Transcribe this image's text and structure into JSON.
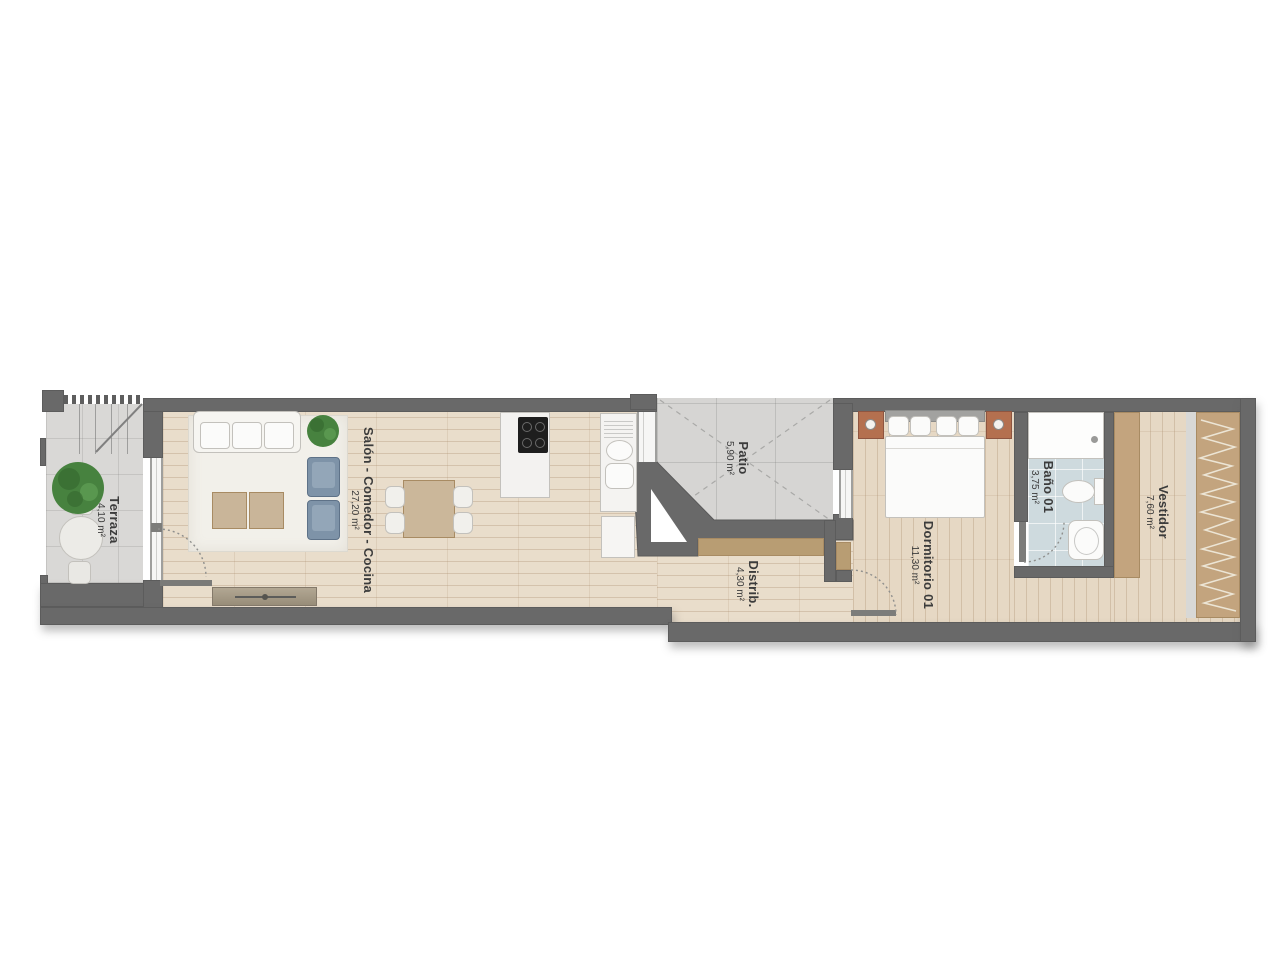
{
  "rooms": [
    {
      "name": "Terraza",
      "area": "4,10 m²"
    },
    {
      "name": "Salón - Comedor - Cocina",
      "area": "27,20 m²"
    },
    {
      "name": "Patio",
      "area": "5,90 m²"
    },
    {
      "name": "Distrib.",
      "area": "4,30 m²"
    },
    {
      "name": "Dormitorio 01",
      "area": "11,30 m²"
    },
    {
      "name": "Baño 01",
      "area": "3,75 m²"
    },
    {
      "name": "Vestidor",
      "area": "7,60 m²"
    }
  ],
  "colors": {
    "wall": "#696969",
    "wood": "#e9ddcb",
    "wood2": "#e6d8c4",
    "concrete": "#d9d8d6",
    "patio": "#d6d5d3",
    "bath-floor": "#cedade",
    "tan": "#c3a47e",
    "tan-dark": "#b89d73",
    "rug": "#f2f0ea",
    "chair-blue": "#7e93a8",
    "terracotta": "#b4704f",
    "fixture": "#fbfbfa",
    "label": "#3c3c3c"
  }
}
